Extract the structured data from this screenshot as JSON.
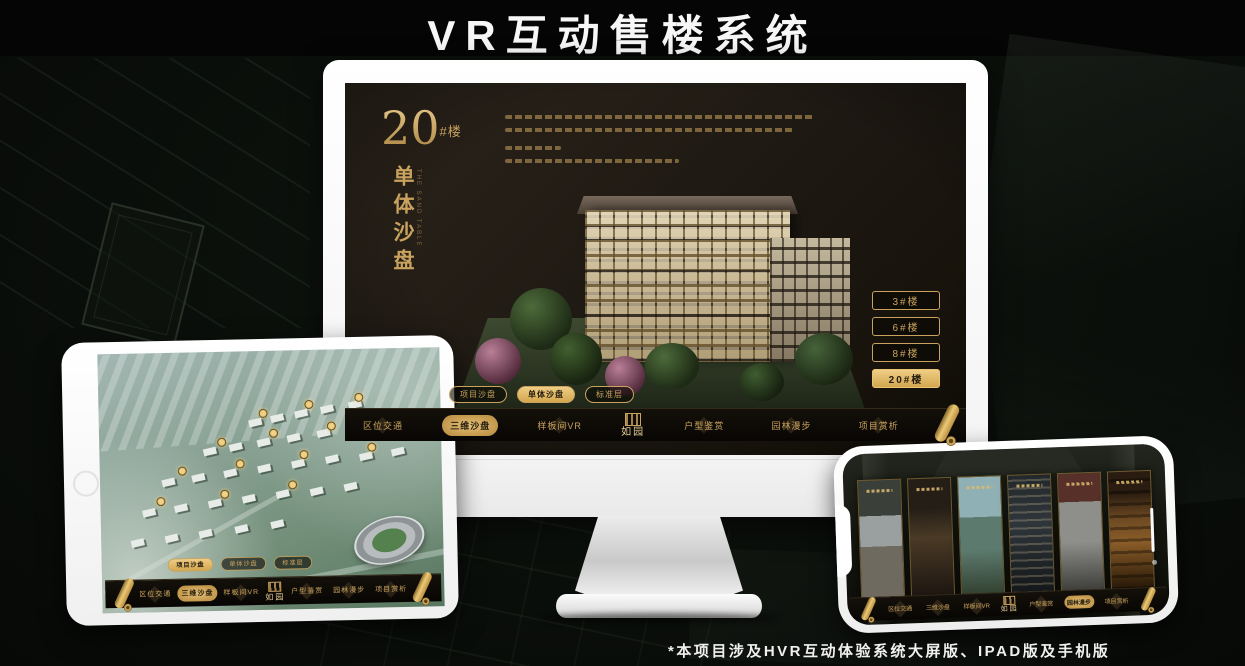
{
  "page": {
    "title": "VR互动售楼系统",
    "footnote": "*本项目涉及HVR互动体验系统大屏版、IPAD版及手机版"
  },
  "brand": {
    "logo_name": "如园",
    "gold": "#c9a25e",
    "gold_active": "#e2ba6c"
  },
  "desktop": {
    "headline": {
      "number": "20",
      "suffix": "#楼",
      "vertical": "单体沙盘",
      "vertical_en": "THE SAND TABLE"
    },
    "floor_buttons": [
      {
        "label": "3#楼",
        "active": false
      },
      {
        "label": "6#楼",
        "active": false
      },
      {
        "label": "8#楼",
        "active": false
      },
      {
        "label": "20#楼",
        "active": true
      }
    ],
    "sub_tabs": [
      {
        "label": "项目沙盘",
        "active": false
      },
      {
        "label": "单体沙盘",
        "active": true
      },
      {
        "label": "标准层",
        "active": false
      }
    ],
    "nav_items": [
      {
        "label": "区位交通",
        "active": false
      },
      {
        "label": "三维沙盘",
        "active": true
      },
      {
        "label": "样板间VR",
        "active": false
      },
      {
        "label": "户型鉴赏",
        "active": false
      },
      {
        "label": "园林漫步",
        "active": false
      },
      {
        "label": "项目赏析",
        "active": false
      }
    ]
  },
  "tablet": {
    "sub_tabs": [
      {
        "label": "项目沙盘",
        "active": true
      },
      {
        "label": "单体沙盘",
        "active": false
      },
      {
        "label": "标准层",
        "active": false
      }
    ],
    "nav_items": [
      {
        "label": "区位交通",
        "active": false
      },
      {
        "label": "三维沙盘",
        "active": true
      },
      {
        "label": "样板间VR",
        "active": false
      },
      {
        "label": "户型鉴赏",
        "active": false
      },
      {
        "label": "园林漫步",
        "active": false
      },
      {
        "label": "项目赏析",
        "active": false
      }
    ]
  },
  "phone": {
    "nav_items": [
      {
        "label": "区位交通",
        "active": false
      },
      {
        "label": "三维沙盘",
        "active": false
      },
      {
        "label": "样板间VR",
        "active": false
      },
      {
        "label": "户型鉴赏",
        "active": false
      },
      {
        "label": "园林漫步",
        "active": true
      },
      {
        "label": "项目赏析",
        "active": false
      }
    ]
  }
}
